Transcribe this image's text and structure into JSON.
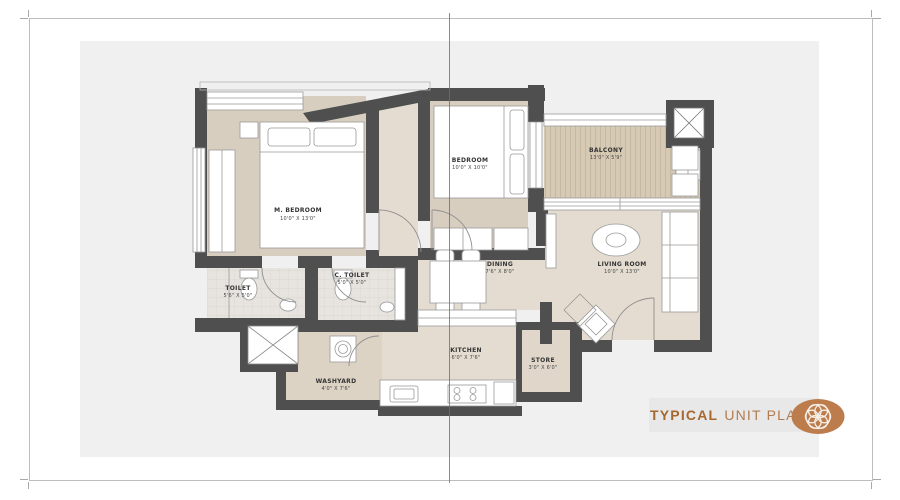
{
  "footer": {
    "title_bold": "TYPICAL",
    "title_rest": "UNIT PLAN"
  },
  "plan": {
    "rooms": [
      {
        "name": "M. BEDROOM",
        "dims": "10'0\" X 13'0\""
      },
      {
        "name": "BEDROOM",
        "dims": "10'0\" X 10'0\""
      },
      {
        "name": "BALCONY",
        "dims": "13'0\" X 5'9\""
      },
      {
        "name": "LIVING ROOM",
        "dims": "10'0\" X 13'0\""
      },
      {
        "name": "DINING",
        "dims": "7'6\" X 8'0\""
      },
      {
        "name": "KITCHEN",
        "dims": "6'0\" X 7'6\""
      },
      {
        "name": "STORE",
        "dims": "3'0\" X 6'0\""
      },
      {
        "name": "TOILET",
        "dims": "5'6\" X 5'0\""
      },
      {
        "name": "C. TOILET",
        "dims": "5'0\" X 5'0\""
      },
      {
        "name": "WASHYARD",
        "dims": "4'0\" X 7'6\""
      }
    ]
  },
  "colors": {
    "accent_copper": "#bd7c4c",
    "wall": "#4f4f4f"
  }
}
